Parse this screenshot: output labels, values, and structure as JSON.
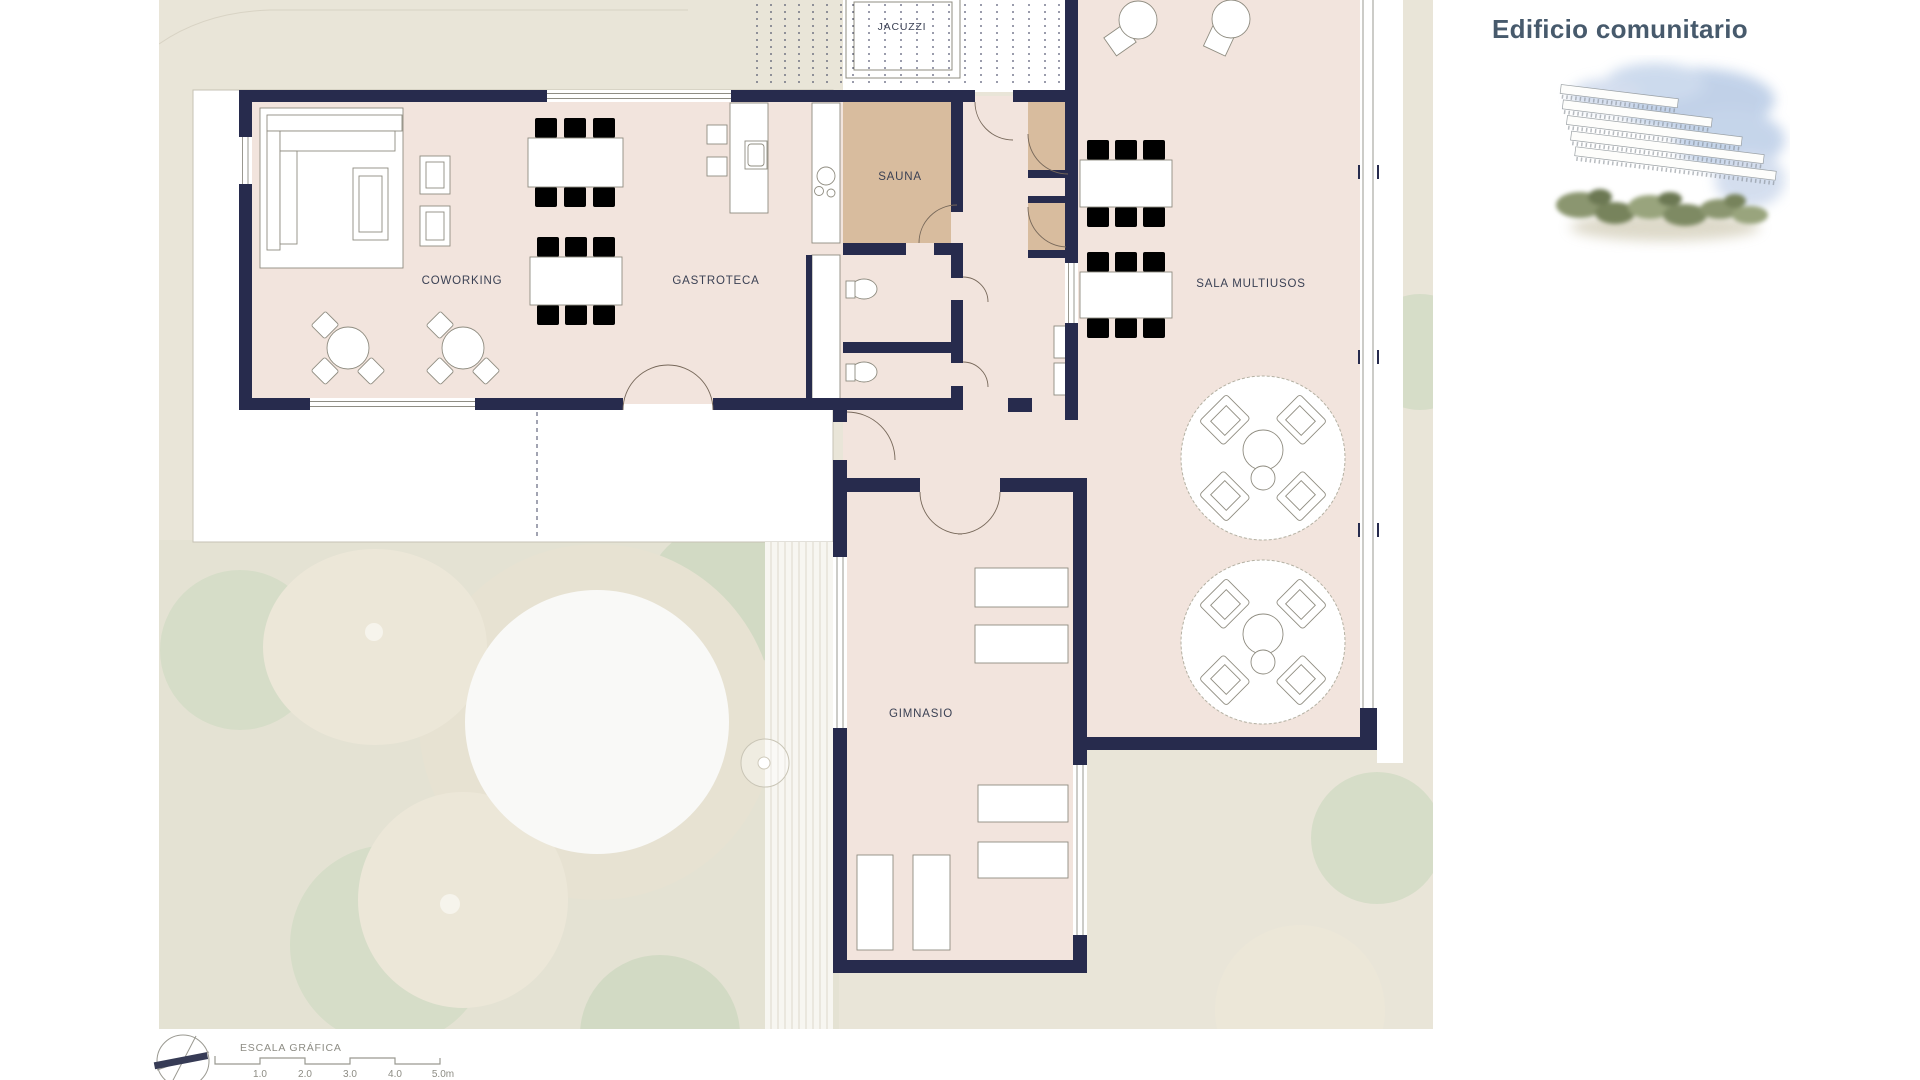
{
  "page": {
    "title": "Edificio comunitario"
  },
  "plan": {
    "rooms": [
      {
        "id": "jacuzzi",
        "label": "JACUZZI"
      },
      {
        "id": "sauna",
        "label": "SAUNA"
      },
      {
        "id": "coworking",
        "label": "COWORKING"
      },
      {
        "id": "gastroteca",
        "label": "GASTROTECA"
      },
      {
        "id": "sala-multiusos",
        "label": "SALA MULTIUSOS"
      },
      {
        "id": "gimnasio",
        "label": "GIMNASIO"
      }
    ],
    "scale_bar": {
      "title": "ESCALA GRÁFICA",
      "ticks": [
        "1.0",
        "2.0",
        "3.0",
        "4.0",
        "5.0m"
      ]
    },
    "icons": {
      "compass": "north-arrow"
    }
  },
  "palette": {
    "wall": "#272b4d",
    "floor": "#f2e4dd",
    "sauna": "#d8bc9e",
    "site": "#e9e5d8",
    "sage": "#d6ddc8",
    "cream": "#ece7d8",
    "navyText": "#3b4154",
    "grayText": "#8d8c84",
    "title": "#475a6c",
    "arc": "#77685a",
    "furn": "#8f8c80",
    "windowLine": "#8f8d84"
  }
}
